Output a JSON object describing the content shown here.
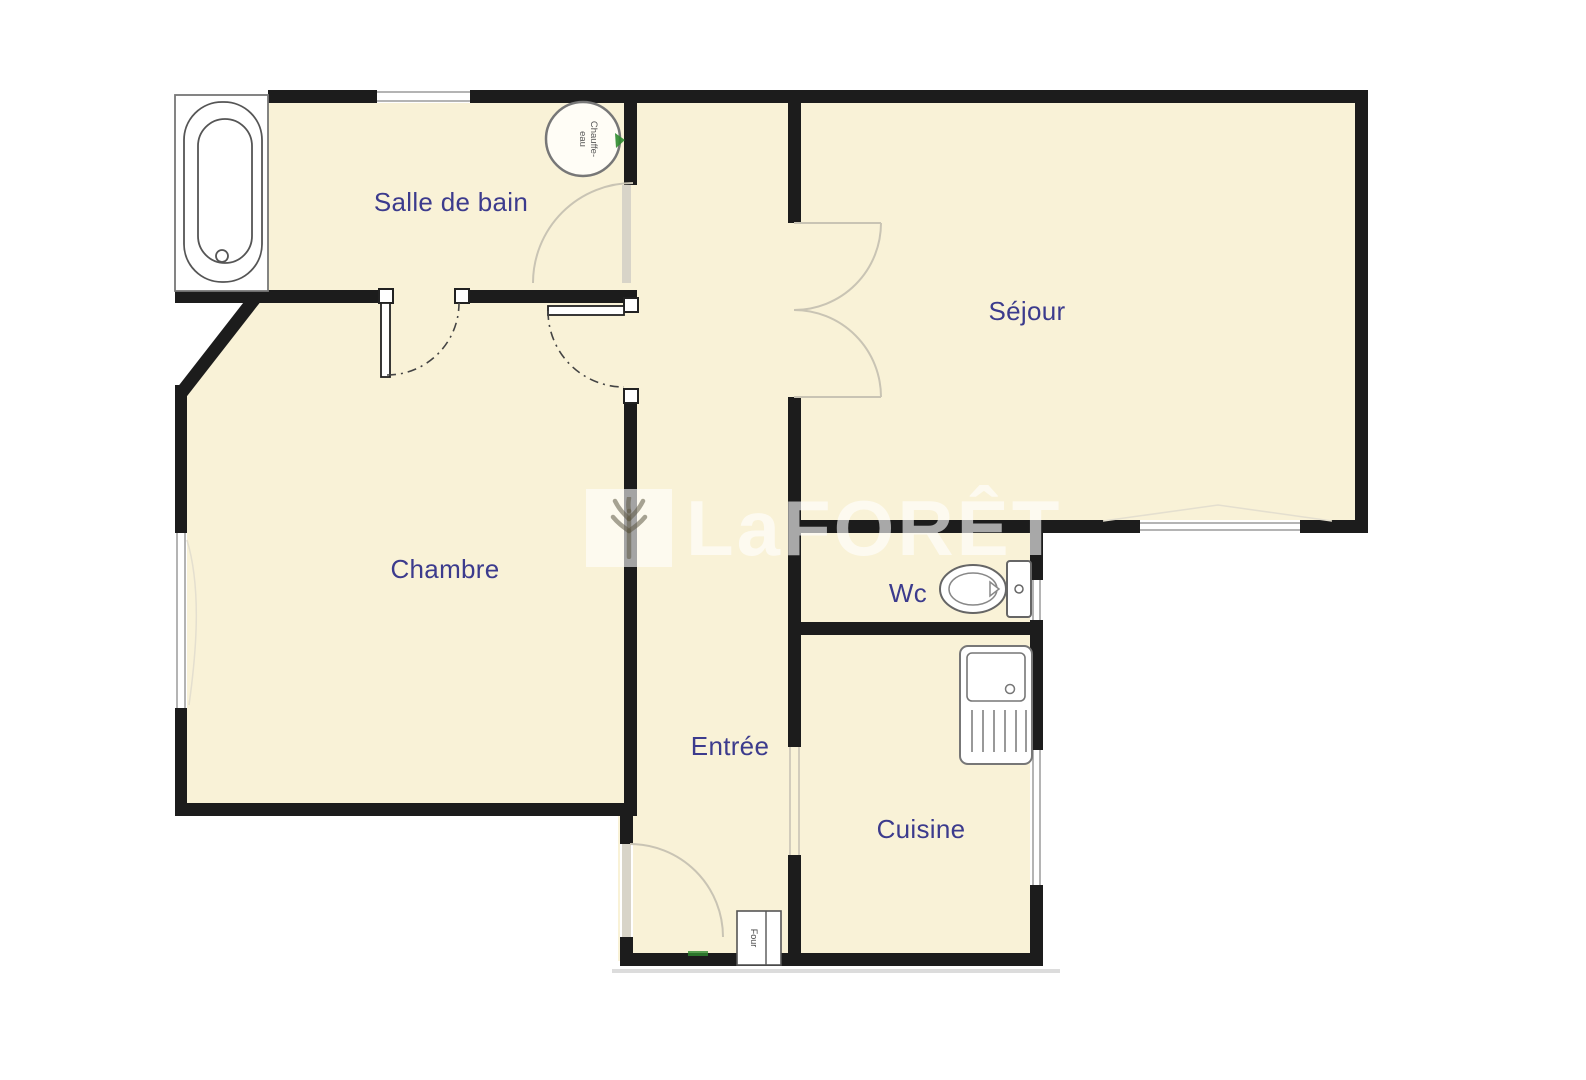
{
  "rooms": {
    "salle_de_bain": {
      "label": "Salle de bain"
    },
    "sejour": {
      "label": "Séjour"
    },
    "chambre": {
      "label": "Chambre"
    },
    "entree": {
      "label": "Entrée"
    },
    "wc": {
      "label": "Wc"
    },
    "cuisine": {
      "label": "Cuisine"
    }
  },
  "fixtures": {
    "chauffe_eau": {
      "line1": "Chauffe-",
      "line2": "eau"
    },
    "four": {
      "label": "Four"
    }
  },
  "watermark": {
    "brand": "LaFORÊT"
  },
  "colors": {
    "wall": "#1c1c1c",
    "floor": "#f9f2d7",
    "room_label": "#3c3b8d",
    "door_arc": "#c9c4b4",
    "fixture_outline": "#666666",
    "accent_green": "#2f8b2f",
    "watermark_white": "rgba(255,255,255,0.62)"
  }
}
